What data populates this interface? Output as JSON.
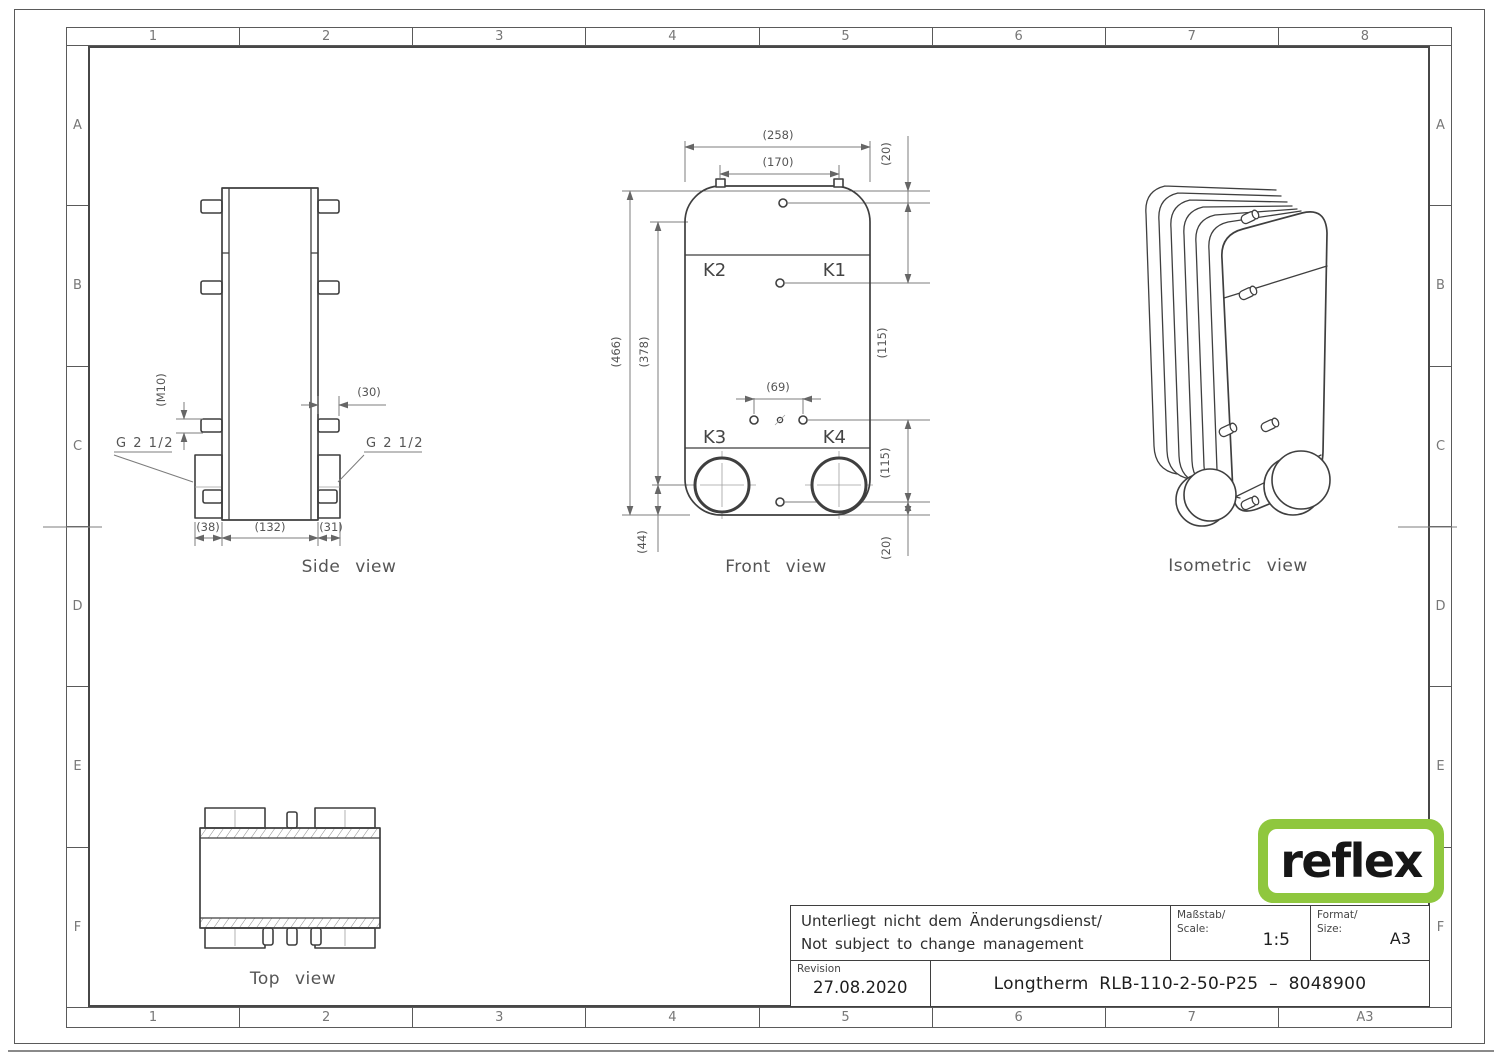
{
  "sheet": {
    "frame": {
      "top_labels": [
        "1",
        "2",
        "3",
        "4",
        "5",
        "6",
        "7",
        "8"
      ],
      "bottom_labels": [
        "1",
        "2",
        "3",
        "4",
        "5",
        "6",
        "7",
        "A3"
      ],
      "left_labels": [
        "A",
        "B",
        "C",
        "D",
        "E",
        "F"
      ],
      "right_labels": [
        "A",
        "B",
        "C",
        "D",
        "E",
        "F"
      ]
    }
  },
  "views": {
    "side": {
      "caption": "Side view",
      "dims": {
        "m10": "(M10)",
        "len30": "(30)",
        "w38": "(38)",
        "w132": "(132)",
        "w31": "(31)"
      },
      "connections": {
        "left": "G 2 1/2",
        "right": "G 2 1/2"
      }
    },
    "front": {
      "caption": "Front view",
      "port_labels": {
        "k1": "K1",
        "k2": "K2",
        "k3": "K3",
        "k4": "K4"
      },
      "dims": {
        "w258": "(258)",
        "w170": "(170)",
        "h20_top": "(20)",
        "h115_top": "(115)",
        "h466": "(466)",
        "h378": "(378)",
        "w69": "(69)",
        "h115_bottom": "(115)",
        "h44": "(44)",
        "h20_bottom": "(20)"
      }
    },
    "top": {
      "caption": "Top view"
    },
    "isometric": {
      "caption": "Isometric view"
    }
  },
  "title_block": {
    "change_note_de": "Unterliegt nicht dem Änderungsdienst/",
    "change_note_en": "Not subject to change management",
    "scale_label_de": "Maßstab/",
    "scale_label_en": "Scale:",
    "scale_value": "1:5",
    "format_label_de": "Format/",
    "format_label_en": "Size:",
    "format_value": "A3",
    "revision_label": "Revision",
    "revision_date": "27.08.2020",
    "drawing_title": "Longtherm RLB-110-2-50-P25 – 8048900"
  },
  "logo": {
    "text": "reflex",
    "green": "#8fc73e"
  }
}
